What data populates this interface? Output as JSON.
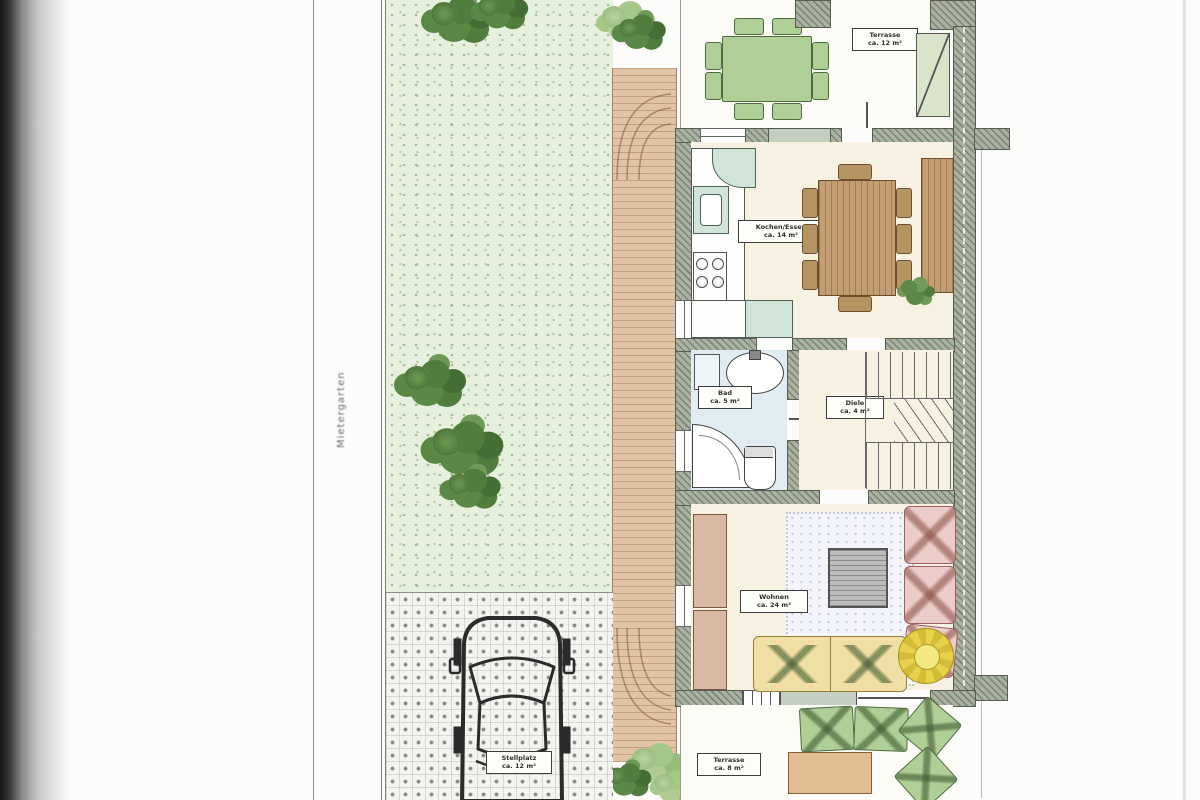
{
  "labels": {
    "boundary_vertical": "Mietergarten",
    "terrace_top": {
      "name": "Terrasse",
      "area": "ca. 12 m²"
    },
    "kitchen": {
      "name": "Kochen/Essen",
      "area": "ca. 14 m²"
    },
    "bath": {
      "name": "Bad",
      "area": "ca. 5 m²"
    },
    "hall": {
      "name": "Diele",
      "area": "ca. 4 m²"
    },
    "living": {
      "name": "Wohnen",
      "area": "ca. 24 m²"
    },
    "terrace_bottom": {
      "name": "Terrasse",
      "area": "ca. 8 m²"
    },
    "parking": {
      "name": "Stellplatz",
      "area": "ca. 12 m²"
    }
  },
  "colors": {
    "garden_green": "#e7efdc",
    "tree_green": "#4d7d38",
    "furniture_green": "#aed093",
    "brick_path": "#e3c3a2",
    "wall_gray_green": "#a9b3a1",
    "floor_cream": "#f8f1e1",
    "bath_blue": "#dfecf2",
    "kitchen_teal": "#cfe4da",
    "wood_brown": "#c89d6e",
    "sofa_pink": "#eecbc7",
    "sofa_yellow": "#f2df9f",
    "flower_yellow": "#e9d23f"
  }
}
